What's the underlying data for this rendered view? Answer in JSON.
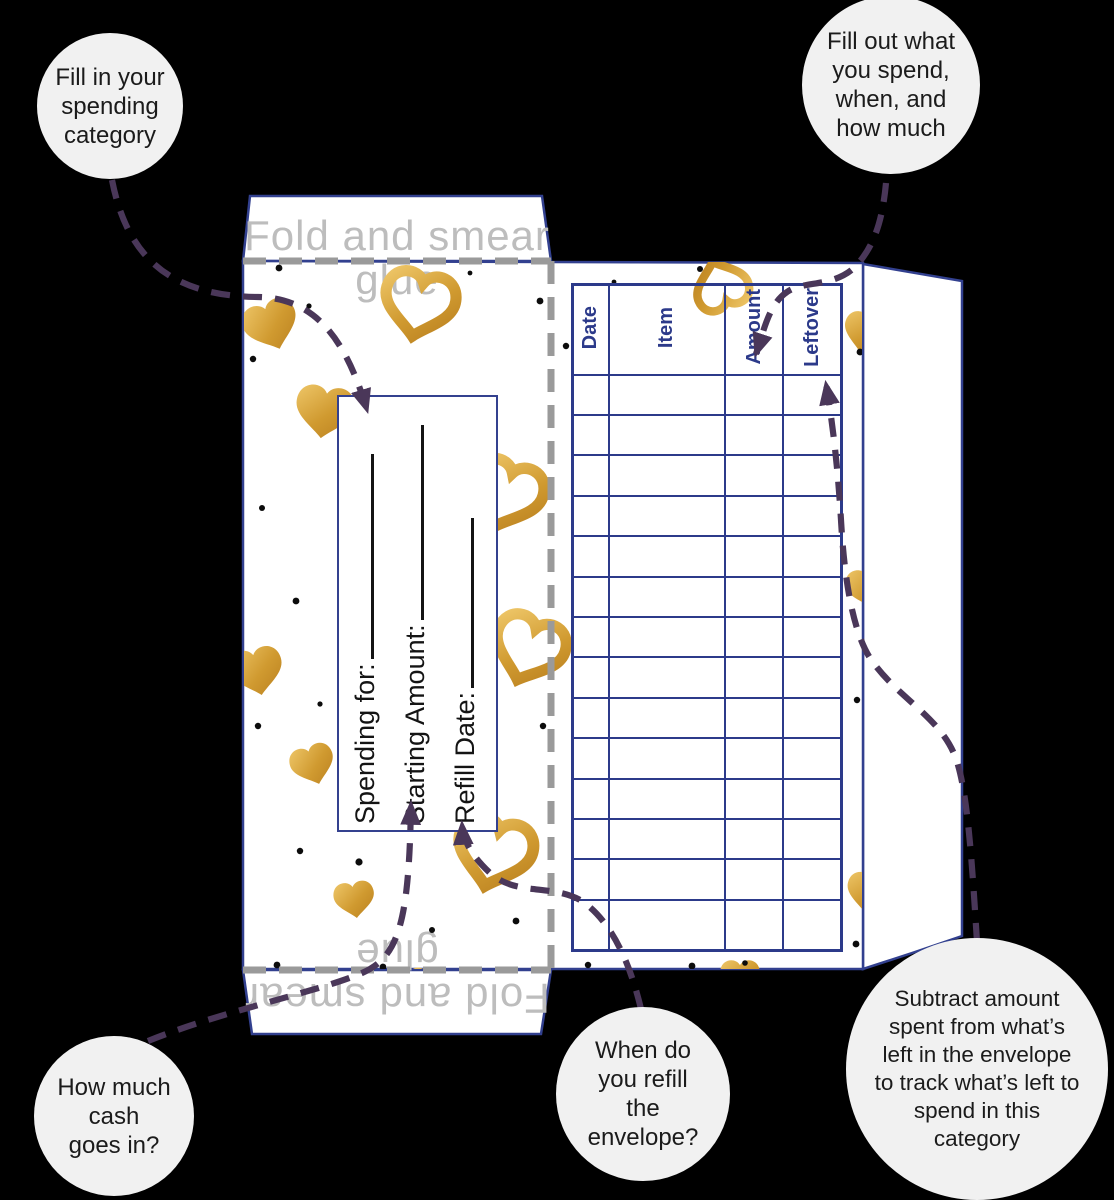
{
  "canvas": {
    "width": 1114,
    "height": 1200,
    "background": "#000000"
  },
  "colors": {
    "paper": "#ffffff",
    "envelope_outline_navy": "#32408f",
    "table_navy": "#2c3a8a",
    "fold_line_gray": "#9a9a9a",
    "flap_text_gray": "#bdbdbd",
    "annotation_purple": "#4a3759",
    "bubble_background": "#f1f1f1",
    "bubble_text": "#1b1b1b",
    "heart_gold": "#d09a30"
  },
  "annotations": {
    "bubbles": [
      {
        "id": "fill-category",
        "text": "Fill in your\nspending\ncategory"
      },
      {
        "id": "fill-out-spend",
        "text": "Fill out what\nyou spend,\nwhen, and\nhow much"
      },
      {
        "id": "cash-in",
        "text": "How much\ncash\ngoes in?"
      },
      {
        "id": "refill-when",
        "text": "When do\nyou refill\nthe\nenvelope?"
      },
      {
        "id": "subtract-leftover",
        "text": "Subtract amount\nspent from what’s\nleft in the envelope\nto track what’s left to\nspend in this\ncategory"
      }
    ]
  },
  "envelope": {
    "flap_label": "Fold and smear\nglue",
    "front": {
      "fields": [
        {
          "label": "Spending for:",
          "value": ""
        },
        {
          "label": "Starting Amount:",
          "value": ""
        },
        {
          "label": "Refill Date:",
          "value": ""
        }
      ]
    },
    "table": {
      "headers": [
        "Date",
        "Item",
        "Amount",
        "Leftover"
      ],
      "data_rows": 14
    }
  }
}
